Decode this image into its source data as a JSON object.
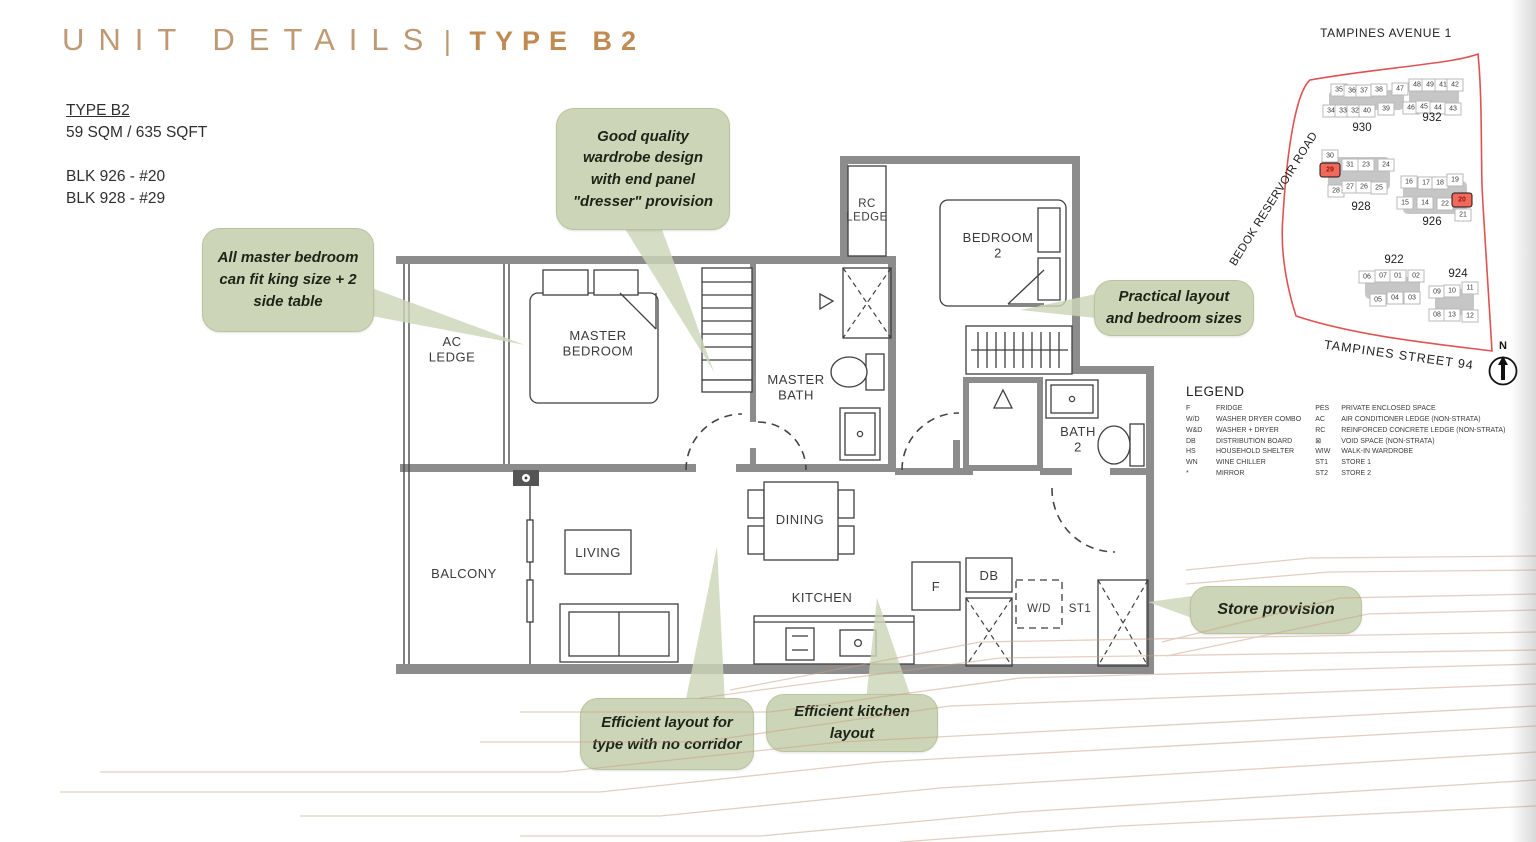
{
  "header": {
    "title_left": "UNIT DETAILS",
    "title_divider": "|",
    "title_right": "TYPE B2"
  },
  "unit_info": {
    "type": "TYPE B2",
    "area": "59 SQM / 635 SQFT",
    "block_lines": [
      "BLK 926 - #20",
      "BLK 928 - #29"
    ]
  },
  "callouts": {
    "master_bed": "All master bedroom can fit king size + 2 side table",
    "wardrobe": "Good quality wardrobe design with end panel \"dresser\" provision",
    "practical": "Practical layout and bedroom sizes",
    "store": "Store provision",
    "no_corridor": "Efficient layout for type with no corridor",
    "kitchen": "Efficient kitchen layout"
  },
  "floorplan": {
    "rooms": {
      "ac_ledge": "AC LEDGE",
      "master_bedroom": "MASTER BEDROOM",
      "master_bath": "MASTER BATH",
      "rc_ledge": "RC LEDGE",
      "bedroom_2": "BEDROOM 2",
      "bath_2": "BATH 2",
      "balcony": "BALCONY",
      "living": "LIVING",
      "dining": "DINING",
      "kitchen": "KITCHEN",
      "fridge": "F",
      "db": "DB",
      "wd": "W/D",
      "st1": "ST1"
    }
  },
  "legend": {
    "heading": "LEGEND",
    "columns": [
      [
        {
          "abbr": "F",
          "desc": "FRIDGE"
        },
        {
          "abbr": "W/D",
          "desc": "WASHER DRYER COMBO"
        },
        {
          "abbr": "W&D",
          "desc": "WASHER + DRYER"
        },
        {
          "abbr": "DB",
          "desc": "DISTRIBUTION BOARD"
        },
        {
          "abbr": "HS",
          "desc": "HOUSEHOLD SHELTER"
        },
        {
          "abbr": "WN",
          "desc": "WINE CHILLER"
        },
        {
          "abbr": "*",
          "desc": "MIRROR"
        }
      ],
      [
        {
          "abbr": "PES",
          "desc": "PRIVATE ENCLOSED SPACE"
        },
        {
          "abbr": "AC",
          "desc": "AIR CONDITIONER LEDGE (NON-STRATA)"
        },
        {
          "abbr": "RC",
          "desc": "REINFORCED CONCRETE LEDGE (NON-STRATA)"
        },
        {
          "abbr": "⊠",
          "desc": "VOID SPACE (NON-STRATA)"
        },
        {
          "abbr": "WIW",
          "desc": "WALK-IN WARDROBE"
        },
        {
          "abbr": "ST1",
          "desc": "STORE 1"
        },
        {
          "abbr": "ST2",
          "desc": "STORE 2"
        }
      ]
    ]
  },
  "sitemap": {
    "streets": {
      "top": "TAMPINES AVENUE 1",
      "left": "BEDOK RESERVOIR ROAD",
      "bottom": "TAMPINES STREET 94"
    },
    "north": "N",
    "highlighted_units": [
      "29",
      "20"
    ],
    "blocks": [
      {
        "label": "930",
        "label_x": 126,
        "label_y": 110,
        "units": [
          {
            "n": "35",
            "x": 103,
            "y": 72
          },
          {
            "n": "36",
            "x": 116,
            "y": 73
          },
          {
            "n": "37",
            "x": 128,
            "y": 73
          },
          {
            "n": "38",
            "x": 143,
            "y": 72
          },
          {
            "n": "47",
            "x": 164,
            "y": 71
          },
          {
            "n": "34",
            "x": 95,
            "y": 93
          },
          {
            "n": "33",
            "x": 107,
            "y": 93
          },
          {
            "n": "32",
            "x": 119,
            "y": 93
          },
          {
            "n": "40",
            "x": 131,
            "y": 93
          },
          {
            "n": "39",
            "x": 150,
            "y": 91
          }
        ]
      },
      {
        "label": "932",
        "label_x": 196,
        "label_y": 100,
        "units": [
          {
            "n": "48",
            "x": 181,
            "y": 67
          },
          {
            "n": "49",
            "x": 194,
            "y": 67
          },
          {
            "n": "41",
            "x": 207,
            "y": 67
          },
          {
            "n": "42",
            "x": 219,
            "y": 67
          },
          {
            "n": "46",
            "x": 175,
            "y": 90
          },
          {
            "n": "45",
            "x": 188,
            "y": 89
          },
          {
            "n": "44",
            "x": 202,
            "y": 90
          },
          {
            "n": "43",
            "x": 217,
            "y": 91
          }
        ]
      },
      {
        "label": "928",
        "label_x": 125,
        "label_y": 189,
        "units": [
          {
            "n": "30",
            "x": 94,
            "y": 138
          },
          {
            "n": "29",
            "x": 94,
            "y": 152
          },
          {
            "n": "31",
            "x": 114,
            "y": 147
          },
          {
            "n": "23",
            "x": 130,
            "y": 147
          },
          {
            "n": "24",
            "x": 150,
            "y": 147
          },
          {
            "n": "28",
            "x": 100,
            "y": 173
          },
          {
            "n": "27",
            "x": 114,
            "y": 169
          },
          {
            "n": "26",
            "x": 128,
            "y": 169
          },
          {
            "n": "25",
            "x": 143,
            "y": 170
          }
        ]
      },
      {
        "label": "926",
        "label_x": 196,
        "label_y": 204,
        "units": [
          {
            "n": "16",
            "x": 173,
            "y": 164
          },
          {
            "n": "17",
            "x": 190,
            "y": 165
          },
          {
            "n": "18",
            "x": 204,
            "y": 165
          },
          {
            "n": "19",
            "x": 219,
            "y": 162
          },
          {
            "n": "20",
            "x": 226,
            "y": 182
          },
          {
            "n": "15",
            "x": 169,
            "y": 185
          },
          {
            "n": "14",
            "x": 189,
            "y": 185
          },
          {
            "n": "22",
            "x": 209,
            "y": 186
          },
          {
            "n": "21",
            "x": 227,
            "y": 197
          }
        ]
      },
      {
        "label": "922",
        "label_x": 158,
        "label_y": 242,
        "units": [
          {
            "n": "06",
            "x": 131,
            "y": 259
          },
          {
            "n": "07",
            "x": 147,
            "y": 258
          },
          {
            "n": "01",
            "x": 162,
            "y": 258
          },
          {
            "n": "02",
            "x": 180,
            "y": 258
          },
          {
            "n": "05",
            "x": 142,
            "y": 282
          },
          {
            "n": "04",
            "x": 159,
            "y": 280
          },
          {
            "n": "03",
            "x": 176,
            "y": 280
          }
        ]
      },
      {
        "label": "924",
        "label_x": 222,
        "label_y": 256,
        "units": [
          {
            "n": "09",
            "x": 201,
            "y": 274
          },
          {
            "n": "10",
            "x": 216,
            "y": 273
          },
          {
            "n": "11",
            "x": 234,
            "y": 270
          },
          {
            "n": "08",
            "x": 201,
            "y": 297
          },
          {
            "n": "13",
            "x": 216,
            "y": 297
          },
          {
            "n": "12",
            "x": 234,
            "y": 298
          }
        ]
      }
    ]
  },
  "colors": {
    "accent_tan": "#BD9A73",
    "accent_bold": "#C08B52",
    "callout_green": "#CDD5B8",
    "wall_gray": "#8C8C8C",
    "map_red": "#E05252",
    "highlight_red": "#F2695C",
    "contour_tan": "#C8A184"
  }
}
